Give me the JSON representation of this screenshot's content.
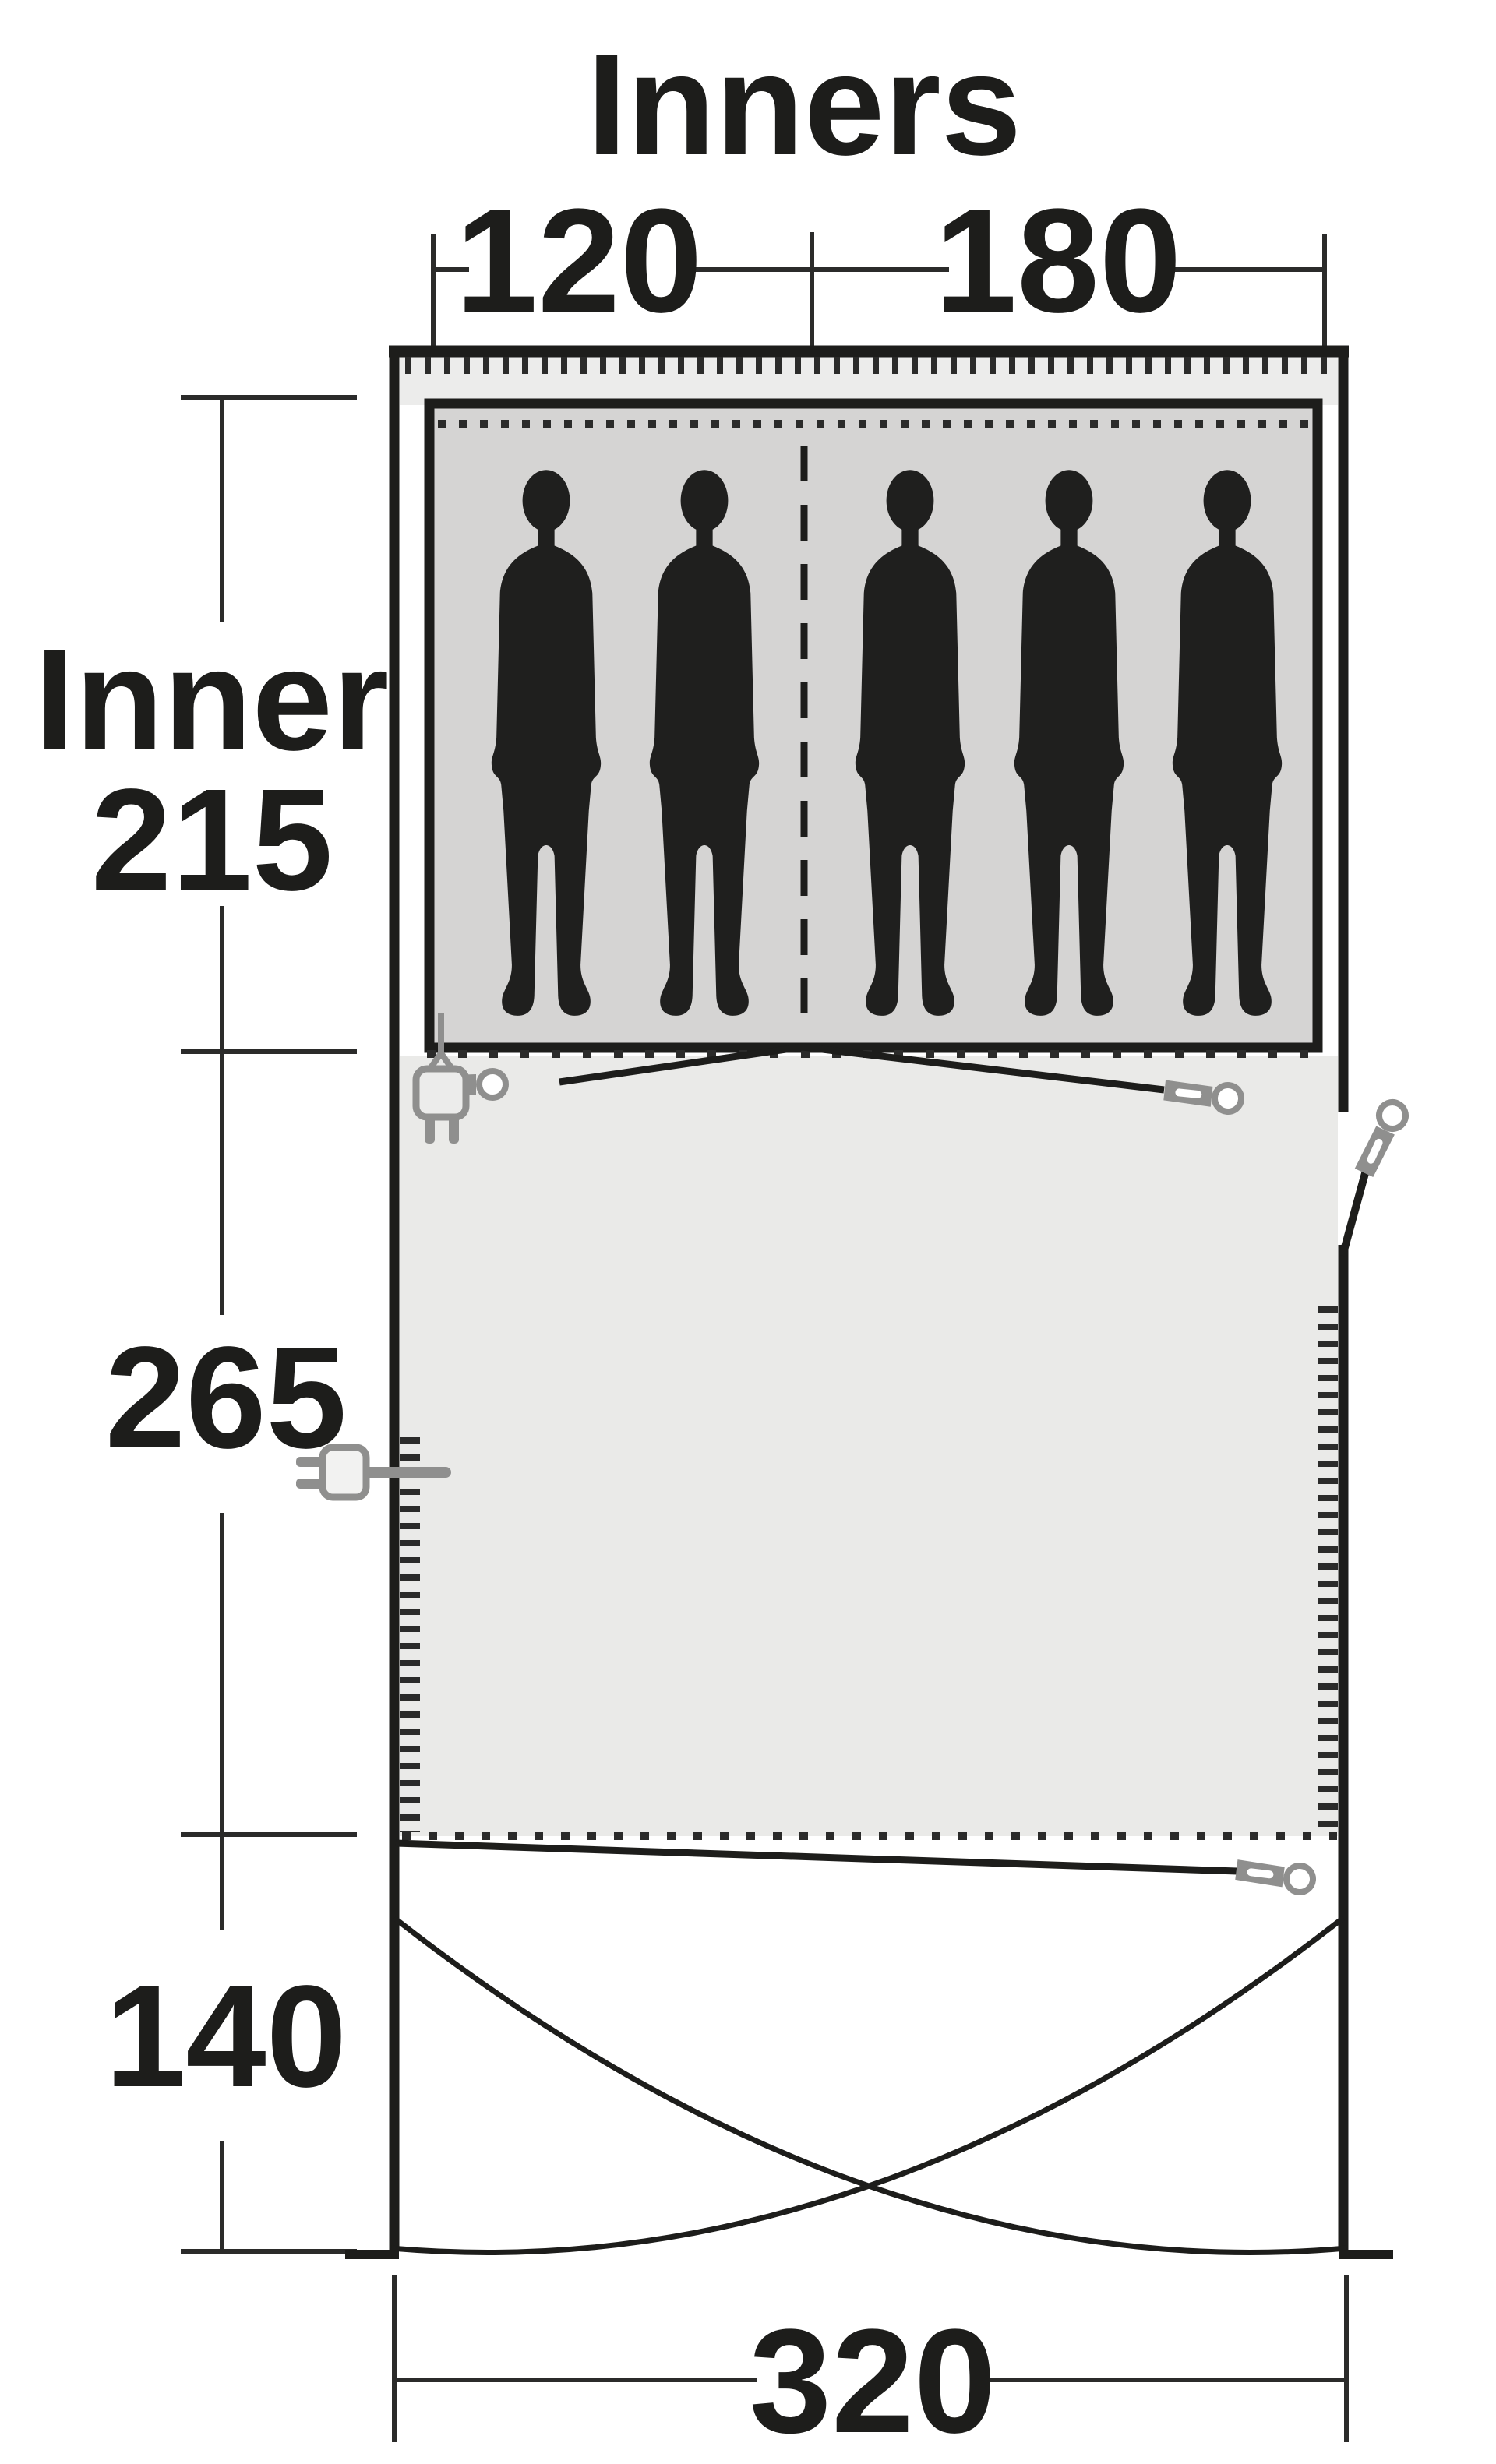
{
  "diagram": {
    "title": "Inners",
    "dimensions": {
      "inner_left_width": "120",
      "inner_right_width": "180",
      "inner_depth_label": "Inner",
      "inner_depth": "215",
      "living_depth": "265",
      "porch_depth": "140",
      "total_width": "320"
    },
    "person_count": 5,
    "icons": [
      "person-icon",
      "tent-peg-icon",
      "power-plug-hanging-icon",
      "power-plug-side-icon"
    ],
    "colors": {
      "line": "#1d1d1b",
      "dim_line": "#2b2b2a",
      "sleeping_fill": "#d5d4d3",
      "living_fill": "#eaeae8",
      "band_fill": "#ececeb",
      "icon_gray": "#8f8f8e",
      "silhouette": "#1f1f1e",
      "background": "#ffffff"
    }
  }
}
